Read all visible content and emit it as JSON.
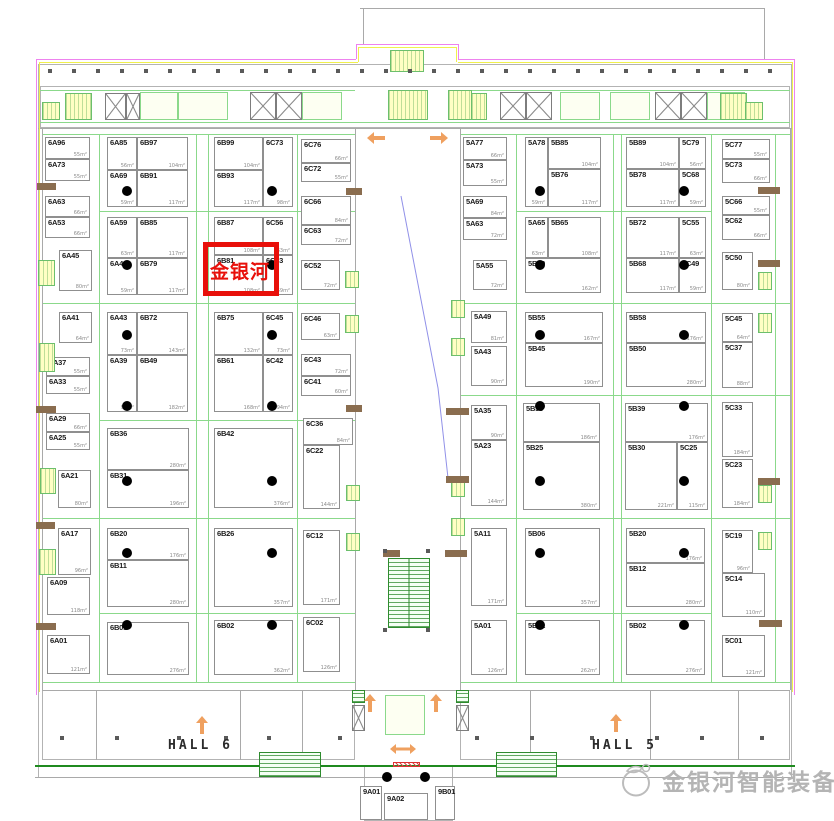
{
  "halls": {
    "left": "HALL 6",
    "right": "HALL 5"
  },
  "highlight": {
    "text": "金银河",
    "booth_id": "6B81",
    "color": "#e8100a"
  },
  "logo": {
    "text": "金银河智能装备",
    "color": "#b4b4b4"
  },
  "colors": {
    "dimension_green": "#8bd98b",
    "boundary_magenta": "#ee82ee",
    "boundary_yellow": "#f0f04c",
    "arrow_orange": "#efa05f",
    "stair_yellow": "#ffffc4",
    "escalator_green": "#2e8b2e",
    "wall_gray": "#a9a9a9",
    "column_dot": "#000000",
    "lintel_brown": "#8a6d4f"
  },
  "booths": [
    {
      "id": "6A96",
      "area": "55m²",
      "x": 45,
      "y": 137,
      "w": 45,
      "h": 22
    },
    {
      "id": "6A73",
      "area": "55m²",
      "x": 45,
      "y": 159,
      "w": 45,
      "h": 22
    },
    {
      "id": "6A63",
      "area": "66m²",
      "x": 45,
      "y": 196,
      "w": 45,
      "h": 21
    },
    {
      "id": "6A53",
      "area": "66m²",
      "x": 45,
      "y": 217,
      "w": 45,
      "h": 21
    },
    {
      "id": "6A45",
      "area": "80m²",
      "x": 59,
      "y": 250,
      "w": 33,
      "h": 41
    },
    {
      "id": "6A41",
      "area": "64m²",
      "x": 59,
      "y": 312,
      "w": 33,
      "h": 31
    },
    {
      "id": "6A37",
      "area": "55m²",
      "x": 46,
      "y": 357,
      "w": 44,
      "h": 19
    },
    {
      "id": "6A33",
      "area": "55m²",
      "x": 46,
      "y": 376,
      "w": 44,
      "h": 18
    },
    {
      "id": "6A29",
      "area": "66m²",
      "x": 46,
      "y": 413,
      "w": 44,
      "h": 19
    },
    {
      "id": "6A25",
      "area": "55m²",
      "x": 46,
      "y": 432,
      "w": 44,
      "h": 18
    },
    {
      "id": "6A21",
      "area": "80m²",
      "x": 58,
      "y": 470,
      "w": 33,
      "h": 38
    },
    {
      "id": "6A17",
      "area": "96m²",
      "x": 58,
      "y": 528,
      "w": 33,
      "h": 47
    },
    {
      "id": "6A09",
      "area": "118m²",
      "x": 47,
      "y": 577,
      "w": 43,
      "h": 38
    },
    {
      "id": "6A01",
      "area": "121m²",
      "x": 47,
      "y": 635,
      "w": 43,
      "h": 39
    },
    {
      "id": "6A85",
      "area": "56m²",
      "x": 107,
      "y": 137,
      "w": 30,
      "h": 33
    },
    {
      "id": "6B97",
      "area": "104m²",
      "x": 137,
      "y": 137,
      "w": 51,
      "h": 33
    },
    {
      "id": "6A69",
      "area": "59m²",
      "x": 107,
      "y": 170,
      "w": 30,
      "h": 37
    },
    {
      "id": "6B91",
      "area": "117m²",
      "x": 137,
      "y": 170,
      "w": 51,
      "h": 37
    },
    {
      "id": "6A59",
      "area": "63m²",
      "x": 107,
      "y": 217,
      "w": 30,
      "h": 41
    },
    {
      "id": "6B85",
      "area": "117m²",
      "x": 137,
      "y": 217,
      "w": 51,
      "h": 41
    },
    {
      "id": "6A49",
      "area": "59m²",
      "x": 107,
      "y": 258,
      "w": 30,
      "h": 37
    },
    {
      "id": "6B79",
      "area": "117m²",
      "x": 137,
      "y": 258,
      "w": 51,
      "h": 37
    },
    {
      "id": "6A43",
      "area": "73m²",
      "x": 107,
      "y": 312,
      "w": 30,
      "h": 43
    },
    {
      "id": "6B72",
      "area": "143m²",
      "x": 137,
      "y": 312,
      "w": 51,
      "h": 43
    },
    {
      "id": "6A39",
      "area": "94m²",
      "x": 107,
      "y": 355,
      "w": 30,
      "h": 57
    },
    {
      "id": "6B49",
      "area": "182m²",
      "x": 137,
      "y": 355,
      "w": 51,
      "h": 57
    },
    {
      "id": "6B36",
      "area": "280m²",
      "x": 107,
      "y": 428,
      "w": 82,
      "h": 42
    },
    {
      "id": "6B31",
      "area": "196m²",
      "x": 107,
      "y": 470,
      "w": 82,
      "h": 38
    },
    {
      "id": "6B20",
      "area": "176m²",
      "x": 107,
      "y": 528,
      "w": 82,
      "h": 32
    },
    {
      "id": "6B11",
      "area": "280m²",
      "x": 107,
      "y": 560,
      "w": 82,
      "h": 47
    },
    {
      "id": "6B01",
      "area": "276m²",
      "x": 107,
      "y": 622,
      "w": 82,
      "h": 53
    },
    {
      "id": "6B99",
      "area": "104m²",
      "x": 214,
      "y": 137,
      "w": 49,
      "h": 33
    },
    {
      "id": "6B93",
      "area": "117m²",
      "x": 214,
      "y": 170,
      "w": 49,
      "h": 37
    },
    {
      "id": "6C73",
      "area": "98m²",
      "x": 263,
      "y": 137,
      "w": 30,
      "h": 70
    },
    {
      "id": "6B87",
      "area": "108m²",
      "x": 214,
      "y": 217,
      "w": 49,
      "h": 38
    },
    {
      "id": "6C56",
      "area": "63m²",
      "x": 263,
      "y": 217,
      "w": 30,
      "h": 38
    },
    {
      "id": "6B81",
      "area": "108m²",
      "x": 214,
      "y": 255,
      "w": 49,
      "h": 40
    },
    {
      "id": "6C53",
      "area": "59m²",
      "x": 263,
      "y": 255,
      "w": 30,
      "h": 40
    },
    {
      "id": "6B75",
      "area": "132m²",
      "x": 214,
      "y": 312,
      "w": 49,
      "h": 43
    },
    {
      "id": "6C45",
      "area": "73m²",
      "x": 263,
      "y": 312,
      "w": 30,
      "h": 43
    },
    {
      "id": "6B61",
      "area": "168m²",
      "x": 214,
      "y": 355,
      "w": 49,
      "h": 57
    },
    {
      "id": "6C42",
      "area": "94m²",
      "x": 263,
      "y": 355,
      "w": 30,
      "h": 57
    },
    {
      "id": "6B42",
      "area": "376m²",
      "x": 214,
      "y": 428,
      "w": 79,
      "h": 80
    },
    {
      "id": "6B26",
      "area": "357m²",
      "x": 214,
      "y": 528,
      "w": 79,
      "h": 79
    },
    {
      "id": "6B02",
      "area": "362m²",
      "x": 214,
      "y": 620,
      "w": 79,
      "h": 55
    },
    {
      "id": "6C76",
      "area": "66m²",
      "x": 301,
      "y": 139,
      "w": 50,
      "h": 24
    },
    {
      "id": "6C72",
      "area": "55m²",
      "x": 301,
      "y": 163,
      "w": 50,
      "h": 19
    },
    {
      "id": "6C66",
      "area": "84m²",
      "x": 301,
      "y": 196,
      "w": 50,
      "h": 29
    },
    {
      "id": "6C63",
      "area": "72m²",
      "x": 301,
      "y": 225,
      "w": 50,
      "h": 20
    },
    {
      "id": "6C52",
      "area": "72m²",
      "x": 301,
      "y": 260,
      "w": 39,
      "h": 30
    },
    {
      "id": "6C46",
      "area": "63m²",
      "x": 301,
      "y": 313,
      "w": 39,
      "h": 27
    },
    {
      "id": "6C43",
      "area": "72m²",
      "x": 301,
      "y": 354,
      "w": 50,
      "h": 22
    },
    {
      "id": "6C41",
      "area": "60m²",
      "x": 301,
      "y": 376,
      "w": 50,
      "h": 20
    },
    {
      "id": "6C36",
      "area": "84m²",
      "x": 303,
      "y": 418,
      "w": 50,
      "h": 27
    },
    {
      "id": "6C22",
      "area": "144m²",
      "x": 303,
      "y": 445,
      "w": 37,
      "h": 64
    },
    {
      "id": "6C12",
      "area": "171m²",
      "x": 303,
      "y": 530,
      "w": 37,
      "h": 75
    },
    {
      "id": "6C02",
      "area": "126m²",
      "x": 303,
      "y": 617,
      "w": 37,
      "h": 55
    },
    {
      "id": "5A77",
      "area": "66m²",
      "x": 463,
      "y": 137,
      "w": 44,
      "h": 23
    },
    {
      "id": "5A73",
      "area": "55m²",
      "x": 463,
      "y": 160,
      "w": 44,
      "h": 26
    },
    {
      "id": "5A69",
      "area": "84m²",
      "x": 463,
      "y": 196,
      "w": 44,
      "h": 22
    },
    {
      "id": "5A63",
      "area": "72m²",
      "x": 463,
      "y": 218,
      "w": 44,
      "h": 22
    },
    {
      "id": "5A55",
      "area": "72m²",
      "x": 473,
      "y": 260,
      "w": 34,
      "h": 30
    },
    {
      "id": "5A49",
      "area": "81m²",
      "x": 471,
      "y": 311,
      "w": 36,
      "h": 32
    },
    {
      "id": "5A43",
      "area": "90m²",
      "x": 471,
      "y": 346,
      "w": 36,
      "h": 40
    },
    {
      "id": "5A35",
      "area": "90m²",
      "x": 471,
      "y": 405,
      "w": 36,
      "h": 35
    },
    {
      "id": "5A23",
      "area": "144m²",
      "x": 471,
      "y": 440,
      "w": 36,
      "h": 66
    },
    {
      "id": "5A11",
      "area": "171m²",
      "x": 471,
      "y": 528,
      "w": 36,
      "h": 78
    },
    {
      "id": "5A01",
      "area": "126m²",
      "x": 471,
      "y": 620,
      "w": 36,
      "h": 55
    },
    {
      "id": "5A78",
      "area": "59m²",
      "x": 525,
      "y": 137,
      "w": 23,
      "h": 70
    },
    {
      "id": "5B85",
      "area": "104m²",
      "x": 548,
      "y": 137,
      "w": 53,
      "h": 32
    },
    {
      "id": "5B76",
      "area": "117m²",
      "x": 548,
      "y": 169,
      "w": 53,
      "h": 38
    },
    {
      "id": "5A65",
      "area": "63m²",
      "x": 525,
      "y": 217,
      "w": 23,
      "h": 41
    },
    {
      "id": "5B65",
      "area": "108m²",
      "x": 548,
      "y": 217,
      "w": 53,
      "h": 41
    },
    {
      "id": "5B60",
      "area": "162m²",
      "x": 525,
      "y": 258,
      "w": 76,
      "h": 35
    },
    {
      "id": "5B55",
      "area": "167m²",
      "x": 525,
      "y": 312,
      "w": 78,
      "h": 31
    },
    {
      "id": "5B45",
      "area": "190m²",
      "x": 525,
      "y": 343,
      "w": 78,
      "h": 44
    },
    {
      "id": "5B35",
      "area": "186m²",
      "x": 523,
      "y": 403,
      "w": 77,
      "h": 39
    },
    {
      "id": "5B25",
      "area": "380m²",
      "x": 523,
      "y": 442,
      "w": 77,
      "h": 68
    },
    {
      "id": "5B06",
      "area": "357m²",
      "x": 525,
      "y": 528,
      "w": 75,
      "h": 79
    },
    {
      "id": "5B01",
      "area": "262m²",
      "x": 525,
      "y": 620,
      "w": 75,
      "h": 55
    },
    {
      "id": "5B89",
      "area": "104m²",
      "x": 626,
      "y": 137,
      "w": 53,
      "h": 32
    },
    {
      "id": "5C79",
      "area": "56m²",
      "x": 679,
      "y": 137,
      "w": 27,
      "h": 32
    },
    {
      "id": "5B78",
      "area": "117m²",
      "x": 626,
      "y": 169,
      "w": 53,
      "h": 38
    },
    {
      "id": "5C68",
      "area": "59m²",
      "x": 679,
      "y": 169,
      "w": 27,
      "h": 38
    },
    {
      "id": "5B72",
      "area": "117m²",
      "x": 626,
      "y": 217,
      "w": 53,
      "h": 41
    },
    {
      "id": "5C55",
      "area": "63m²",
      "x": 679,
      "y": 217,
      "w": 27,
      "h": 41
    },
    {
      "id": "5B68",
      "area": "117m²",
      "x": 626,
      "y": 258,
      "w": 53,
      "h": 35
    },
    {
      "id": "5C49",
      "area": "59m²",
      "x": 679,
      "y": 258,
      "w": 27,
      "h": 35
    },
    {
      "id": "5B58",
      "area": "176m²",
      "x": 626,
      "y": 312,
      "w": 80,
      "h": 31
    },
    {
      "id": "5B50",
      "area": "280m²",
      "x": 626,
      "y": 343,
      "w": 80,
      "h": 44
    },
    {
      "id": "5B39",
      "area": "176m²",
      "x": 625,
      "y": 403,
      "w": 83,
      "h": 39
    },
    {
      "id": "5B30",
      "area": "221m²",
      "x": 625,
      "y": 442,
      "w": 52,
      "h": 68
    },
    {
      "id": "5C25",
      "area": "115m²",
      "x": 677,
      "y": 442,
      "w": 31,
      "h": 68
    },
    {
      "id": "5B20",
      "area": "176m²",
      "x": 626,
      "y": 528,
      "w": 79,
      "h": 35
    },
    {
      "id": "5B12",
      "area": "280m²",
      "x": 626,
      "y": 563,
      "w": 79,
      "h": 44
    },
    {
      "id": "5B02",
      "area": "276m²",
      "x": 626,
      "y": 620,
      "w": 79,
      "h": 55
    },
    {
      "id": "5C77",
      "area": "55m²",
      "x": 722,
      "y": 139,
      "w": 48,
      "h": 20
    },
    {
      "id": "5C73",
      "area": "66m²",
      "x": 722,
      "y": 159,
      "w": 48,
      "h": 24
    },
    {
      "id": "5C66",
      "area": "55m²",
      "x": 722,
      "y": 196,
      "w": 48,
      "h": 19
    },
    {
      "id": "5C62",
      "area": "66m²",
      "x": 722,
      "y": 215,
      "w": 48,
      "h": 25
    },
    {
      "id": "5C50",
      "area": "80m²",
      "x": 722,
      "y": 252,
      "w": 31,
      "h": 38
    },
    {
      "id": "5C45",
      "area": "64m²",
      "x": 722,
      "y": 313,
      "w": 31,
      "h": 29
    },
    {
      "id": "5C37",
      "area": "88m²",
      "x": 722,
      "y": 342,
      "w": 31,
      "h": 46
    },
    {
      "id": "5C33",
      "area": "184m²",
      "x": 722,
      "y": 402,
      "w": 31,
      "h": 55
    },
    {
      "id": "5C23",
      "area": "184m²",
      "x": 722,
      "y": 459,
      "w": 31,
      "h": 49
    },
    {
      "id": "5C19",
      "area": "96m²",
      "x": 722,
      "y": 530,
      "w": 31,
      "h": 43
    },
    {
      "id": "5C14",
      "area": "110m²",
      "x": 722,
      "y": 573,
      "w": 43,
      "h": 44
    },
    {
      "id": "5C01",
      "area": "121m²",
      "x": 722,
      "y": 635,
      "w": 43,
      "h": 42
    },
    {
      "id": "9A01",
      "area": "",
      "x": 360,
      "y": 786,
      "w": 22,
      "h": 34
    },
    {
      "id": "9A02",
      "area": "",
      "x": 384,
      "y": 793,
      "w": 44,
      "h": 27
    },
    {
      "id": "9B01",
      "area": "",
      "x": 435,
      "y": 786,
      "w": 20,
      "h": 34
    }
  ],
  "dots": [
    [
      127,
      191
    ],
    [
      127,
      265
    ],
    [
      127,
      335
    ],
    [
      127,
      406
    ],
    [
      127,
      481
    ],
    [
      127,
      553
    ],
    [
      127,
      625
    ],
    [
      272,
      191
    ],
    [
      272,
      265
    ],
    [
      272,
      335
    ],
    [
      272,
      406
    ],
    [
      272,
      481
    ],
    [
      272,
      553
    ],
    [
      272,
      625
    ],
    [
      540,
      191
    ],
    [
      540,
      265
    ],
    [
      540,
      335
    ],
    [
      540,
      406
    ],
    [
      540,
      481
    ],
    [
      540,
      553
    ],
    [
      540,
      625
    ],
    [
      684,
      191
    ],
    [
      684,
      265
    ],
    [
      684,
      335
    ],
    [
      684,
      406
    ],
    [
      684,
      481
    ],
    [
      684,
      553
    ],
    [
      684,
      625
    ],
    [
      387,
      777
    ],
    [
      425,
      777
    ]
  ],
  "arrows": [
    {
      "x": 367,
      "y": 132,
      "dir": "left"
    },
    {
      "x": 430,
      "y": 132,
      "dir": "right"
    },
    {
      "x": 196,
      "y": 716,
      "dir": "up"
    },
    {
      "x": 364,
      "y": 694,
      "dir": "up"
    },
    {
      "x": 430,
      "y": 694,
      "dir": "up"
    },
    {
      "x": 610,
      "y": 714,
      "dir": "up"
    },
    {
      "x": 390,
      "y": 744,
      "dir": "lr"
    }
  ]
}
